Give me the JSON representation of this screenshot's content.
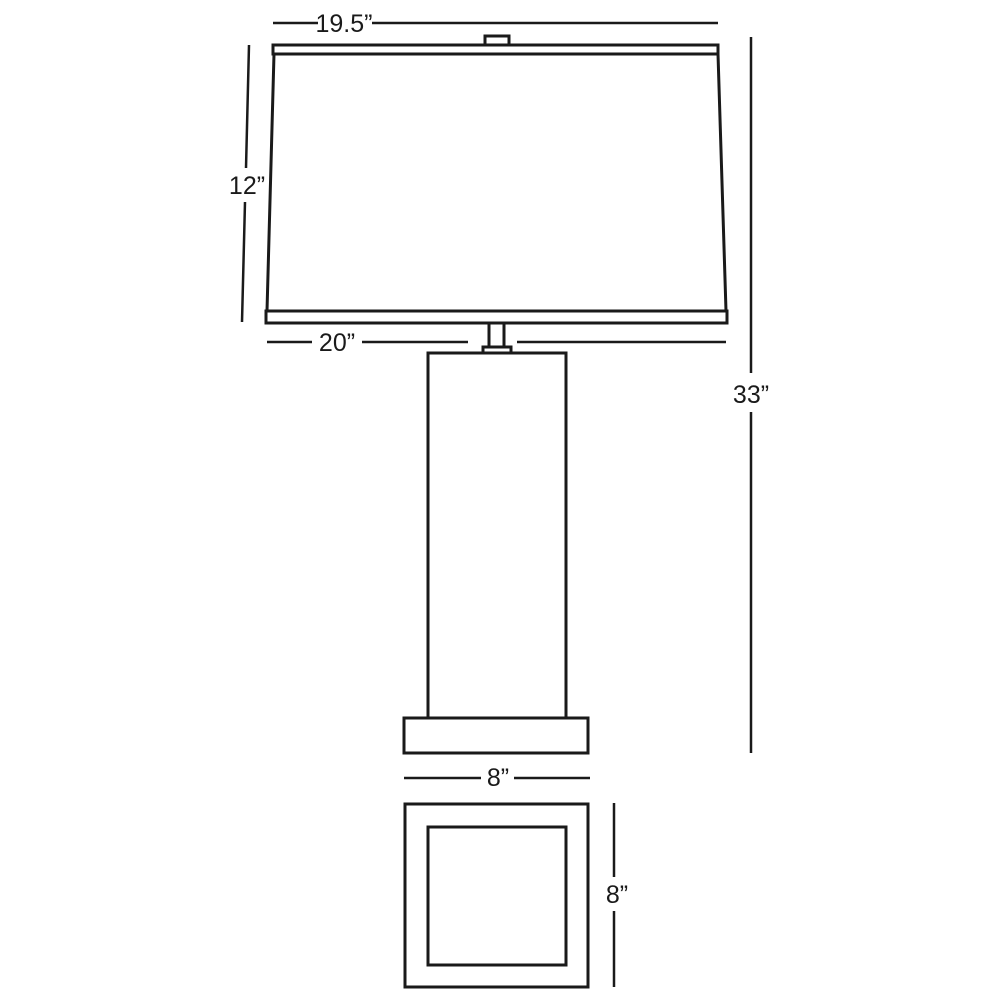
{
  "diagram": {
    "type": "product-dimension-drawing",
    "subject": "table lamp with rectangular shade, column body and square base (side view and base plan view)"
  },
  "colors": {
    "line": "#1a1a1a",
    "background": "#ffffff"
  },
  "labels": {
    "shade_top_width": "19.5”",
    "shade_height": "12”",
    "shade_bottom_width": "20”",
    "overall_height": "33”",
    "base_width": "8”",
    "base_depth": "8”"
  }
}
